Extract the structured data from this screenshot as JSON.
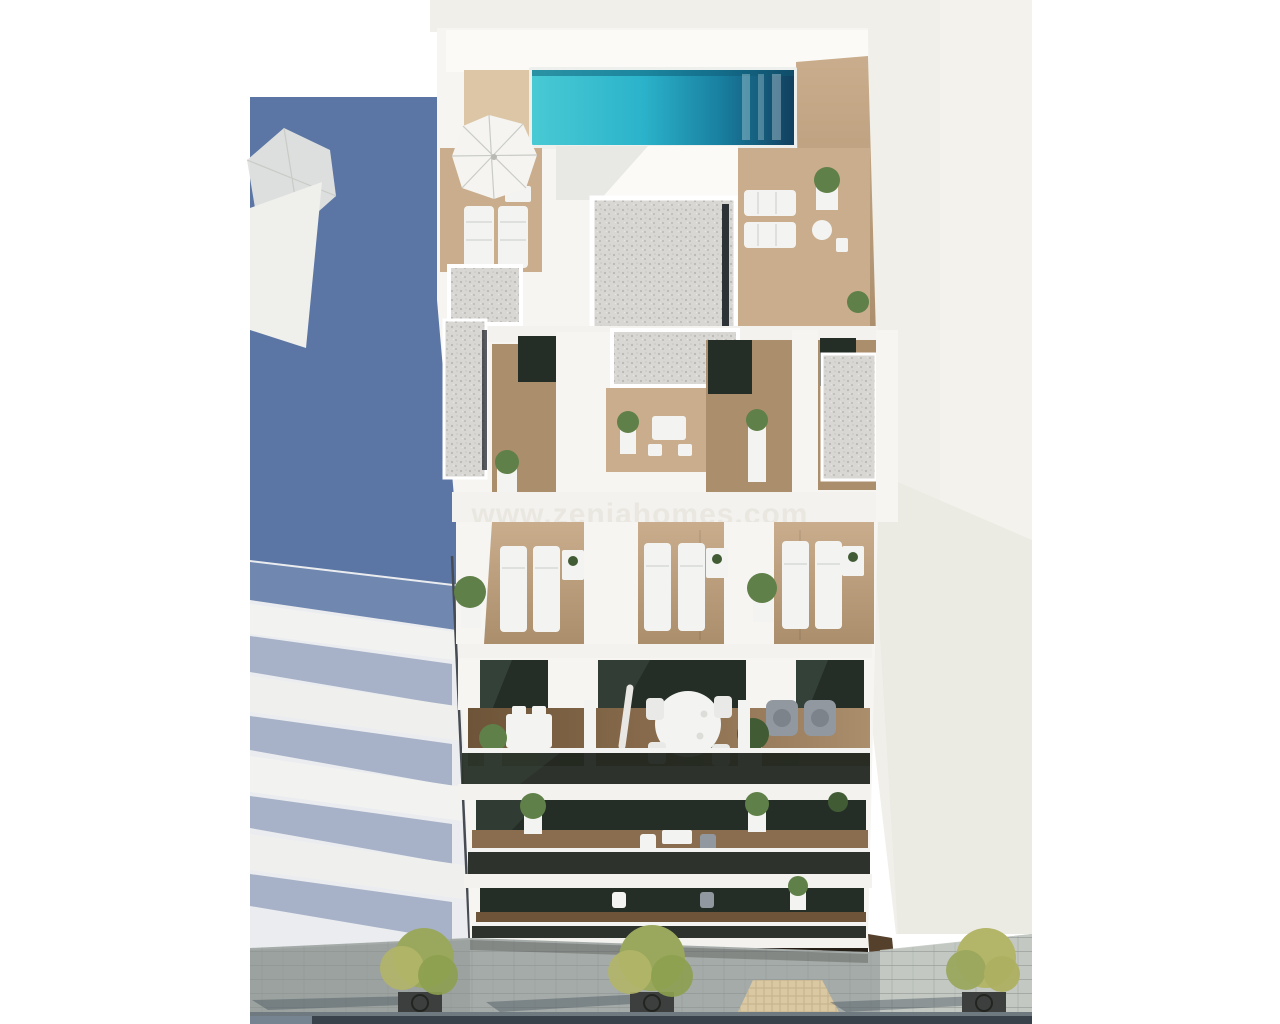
{
  "watermark": {
    "text": "www.zeniahomes.com"
  },
  "colors": {
    "white_bg": "#ffffff",
    "wall_offwhite": "#f1efe9",
    "wall_offwhite_bright": "#f6f4ef",
    "wall_shade": "#eae8e1",
    "shadow_blue": "#5b76a4",
    "slab_shadow": "#a7b2c8",
    "neighbor_slab": "#eaecef",
    "wall_white": "#f6f5f2",
    "roof_bright": "#fbfaf7",
    "slab_white": "#f3f2ee",
    "tan_deck": "#dcc6a5",
    "pool_light": "#49cad4",
    "pool_mid": "#2bb3cb",
    "pool_deep": "#197fa0",
    "pool_dark": "#123f5e",
    "pool_coping": "#eef0ee",
    "wood_light": "#c9ad8c",
    "wood_mid": "#ab8e6c",
    "wood_dark": "#8a6d4e",
    "wood_deep": "#6e5438",
    "gravel": "#d8d7d3",
    "gravel_speck": "#b9b8b4",
    "slot_dark": "#2d3237",
    "glass_dark": "#242e27",
    "glass_sheen": "#3c4a40",
    "balustrade": "#20261f",
    "furniture_white": "#f3f4f2",
    "chair_gray": "#9298a0",
    "plant_green": "#5f8048",
    "plant_dark": "#415c35",
    "tree_olive": "#9aa85e",
    "tree_yellow": "#b3b568",
    "pavement": "#a5aba8",
    "pavement_dark": "#939a98",
    "pavement_light": "#c8ccc7",
    "paver_joint": "#8b928f",
    "mat_beige": "#d9c8a2",
    "grate_dark": "#3c3f3e",
    "shadow_cast": "#4a5560",
    "curb": "#6f7a80",
    "road_dark": "#39424a",
    "storefront_dark": "#261f18",
    "storefront_wood": "#6b5138",
    "watermark_color": "#e8e5de"
  }
}
